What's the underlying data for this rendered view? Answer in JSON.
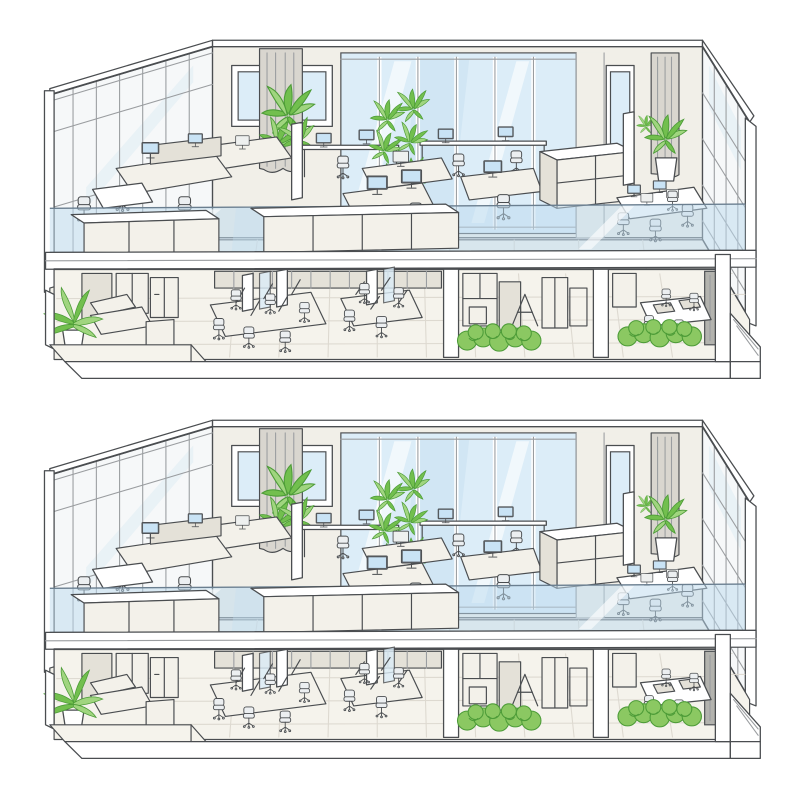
{
  "scene": {
    "title": "Hand-drawn isometric cutaway illustration of a two-storey office building, repeated twice (top and bottom copies)",
    "style": "architectural sketch, white paper, grey ink lines, watercolor accents",
    "copies": [
      {
        "id": "top-illustration",
        "position": "upper half of image"
      },
      {
        "id": "bottom-illustration",
        "position": "lower half of image, near-identical duplicate"
      }
    ],
    "building": {
      "upper_floor": {
        "name": "open-plan office level",
        "items": [
          "glazed curtain wall on left side with grey mullions",
          "glazed wall on right side with grey mullions and white corner post",
          "back wall with framed window picture (blue glass, two mullions)",
          "full-height back glass wall with sky-blue panes and white streaks",
          "entrance door with blue glass panel at right of back wall",
          "small green wall plant beside door",
          "grey curtain at left end and right end of back wall",
          "leafy potted plant at left curtain and at right corner",
          "two tall green planter columns mid-room",
          "left desk cluster with partitions, monitors and task chairs",
          "small white side table with chair",
          "back bench desks with four small monitors and chairs",
          "centre face-to-face desks with two blue monitors and chairs",
          "right desk with monitor and chair",
          "large white storage credenza",
          "thin white partition screen",
          "far-right meeting table with four monitors and four chairs seen through glass",
          "continuous light-blue glass balustrade along the cut edge",
          "two long white sideboard cabinets in front of the balustrade"
        ]
      },
      "lower_floor": {
        "name": "ground office level",
        "items": [
          "lounge corner with palm plant in pot, white sofa and cube ottoman",
          "tall storage cabinets on back wall",
          "two bench-desk clusters with privacy screens, thin monitors and many task chairs",
          "row of low cabinets along the back",
          "white partition columns dividing rooms",
          "utility room with lockers, shelving units and a folded easel",
          "meeting room with table, seat pads, small chairs and dark grey wall panel",
          "two bright-green hedge planters along the front edge",
          "stepped floor slab extending to lower left",
          "white plinth base band and diagonal ramp edge at far right"
        ]
      }
    }
  },
  "colors": {
    "paper": "#ffffff",
    "line": "#4a4d50",
    "lightline": "#9a9da0",
    "grid": "#ddd9d0",
    "wall": "#f1efe8",
    "wallShade": "#e6e3db",
    "clearGlass": "#f6f8f9",
    "glassSky": "#dcedf8",
    "glassDeep": "#c5dff0",
    "balustrade": "#bcd9ee",
    "bandEdge": "#6b7f90",
    "floor": "#f5f3ec",
    "furn": "#f3f1ea",
    "furnShade": "#e4e1d8",
    "curtain": "#d9d6cf",
    "monitorFrame": "#5a5f64",
    "screen": "#c9e3f5",
    "plantDark": "#4d9c38",
    "plantMid": "#72bf4e",
    "plantLight": "#a0d57f",
    "hedge": "#8bc862",
    "darkPanel": "#b3b3ae"
  }
}
